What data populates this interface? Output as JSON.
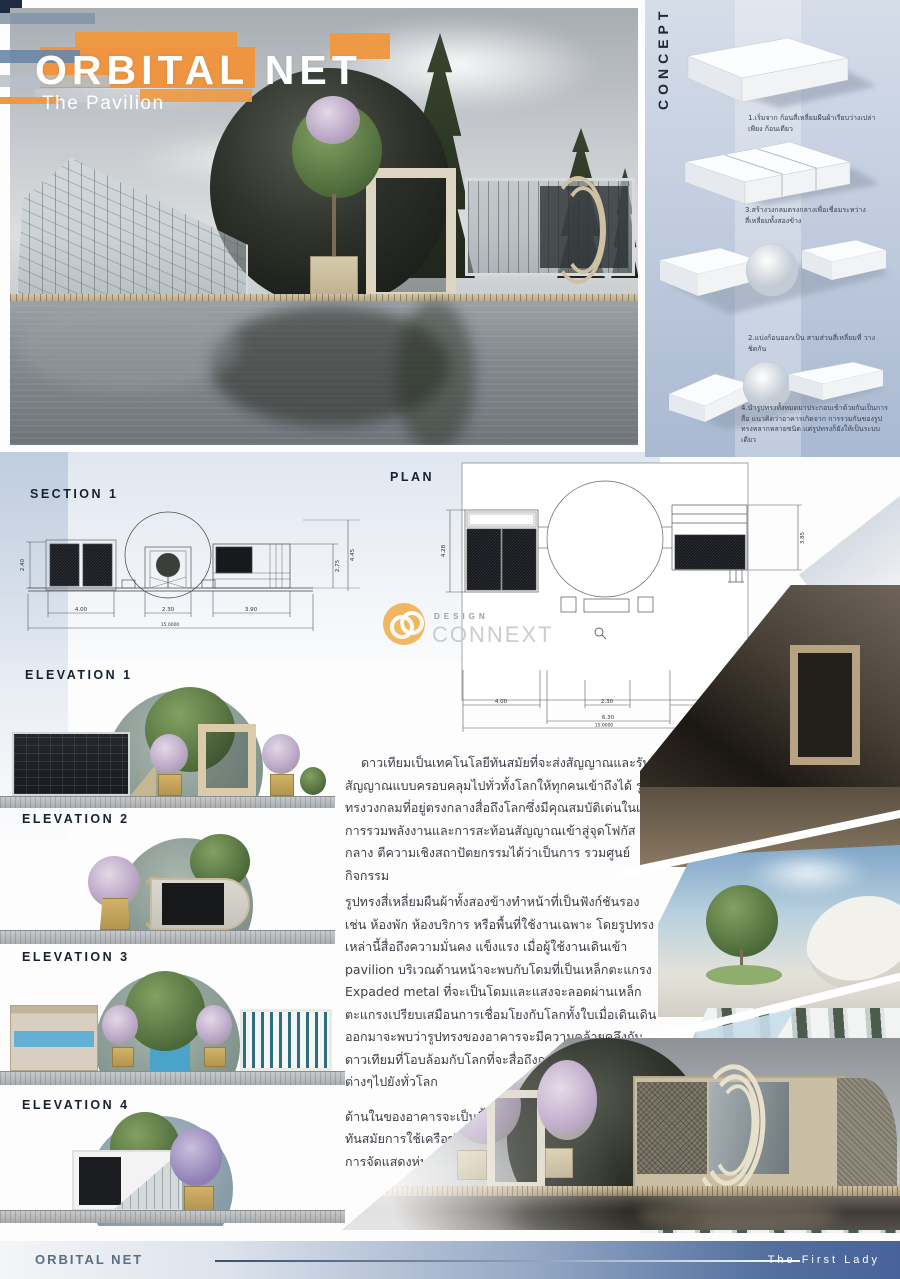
{
  "hero": {
    "title": "ORBITAL NET",
    "subtitle": "The Pavilion"
  },
  "concept": {
    "heading": "CONCEPT",
    "steps": [
      {
        "caption": "1.เริ่มจาก ก้อนสี่เหลี่ยมผืนผ้าเรียบว่างเปล่าเพียง ก้อนเดียว"
      },
      {
        "caption": "3.สร้างวงกลมตรงกลางเพื่อเชื่อมระหว่าง สี่เหลี่ยมทั้งสองข้าง"
      },
      {
        "caption": "2.แบ่งก้อนออกเป็น สามส่วนสี่เหลี่ยมที่ วางชิดกัน"
      },
      {
        "caption": "4.นำรูปทรงทั้งหมดมาประกอบเข้าด้วยกันเป็นการสื่อ แนวคิดว่าอาคารเกิดจาก การรวมกันของรูปทรงหลากหลายชนิด แต่รูปทรงก็ยังให้เป็นระบบเดียว"
      }
    ]
  },
  "section": {
    "label": "SECTION 1",
    "dim_left": "2.40",
    "dim_right_outer": "4.45",
    "dim_right_inner": "2.75",
    "dims_bottom": [
      "4.00",
      "2.30",
      "3.90"
    ],
    "dim_total": "15.0000"
  },
  "plan": {
    "label": "PLAN",
    "dim_left": "4.28",
    "dim_right": "3.85",
    "dims_bottom": [
      "4.00",
      "2.30",
      "3.90"
    ],
    "dim_mid": "6.30",
    "dim_total": "15.0000"
  },
  "elevations": [
    {
      "label": "ELEVATION 1"
    },
    {
      "label": "ELEVATION 2"
    },
    {
      "label": "ELEVATION 3"
    },
    {
      "label": "ELEVATION 4"
    }
  ],
  "description": {
    "p1": "ดาวเทียมเป็นเทคโนโลยีทันสมัยที่จะส่งสัญญาณและรับสัญญาณแบบครอบคลุมไปทั่วทั้งโลกให้ทุกคนเข้าถึงได้ รูปทรงวงกลมที่อยู่ตรงกลางสื่อถึงโลกซึ่งมีคุณสมบัติเด่นในเชิงการรวมพลังงานและการสะท้อนสัญญาณเข้าสู่จุดโฟกัสกลาง ตีความเชิงสถาปัตยกรรมได้ว่าเป็นการ รวมศูนย์กิจกรรม",
    "p2": "รูปทรงสี่เหลี่ยมผืนผ้าทั้งสองข้างทำหน้าที่เป็นฟังก์ชันรอง เช่น ห้องพัก ห้องบริการ หรือพื้นที่ใช้งานเฉพาะ โดยรูปทรงเหล่านี้สื่อถึงความมั่นคง แข็งแรง เมื่อผู้ใช้งานเดินเข้า pavilion บริเวณด้านหน้าจะพบกับโดมที่เป็นเหล็กตะแกรง Expaded metal ที่จะเป็นโดมและแสงจะลอดผ่านเหล็กตะแกรงเปรียบเสมือนการเชื่อมโยงกับโลกทั้งใบเมื่อเดินเดินออกมาจะพบว่ารูปทรงของอาคารจะมีความคล้ายคลึงกับดาวเทียมที่โอบล้อมกับโลกที่จะสื่อถึงการกระจายสัญญาณต่างๆไปยังทั่วโลก",
    "p3": "ด้านในของอาคารจะเป็นพื้นที่จัดแสดงเกี่ยวกับเทคโนโลยีที่ทันสมัยการใช้เครือข่ายต่างๆที่มาจากดาวเทียม และจะมีการจัดแสดงหุ่นจำลองของดาวเทียมที่น่าสนใจต่างๆ",
    "p2_keyword": "Expaded metal"
  },
  "watermark": {
    "top": "DESIGN",
    "bottom": "CONNEXT"
  },
  "footer": {
    "left": "ORBITAL NET",
    "right": "The First Lady"
  },
  "colors": {
    "accent_orange": "#EF9440",
    "navy": "#1D2C42",
    "footer_blue": "#47639A"
  }
}
